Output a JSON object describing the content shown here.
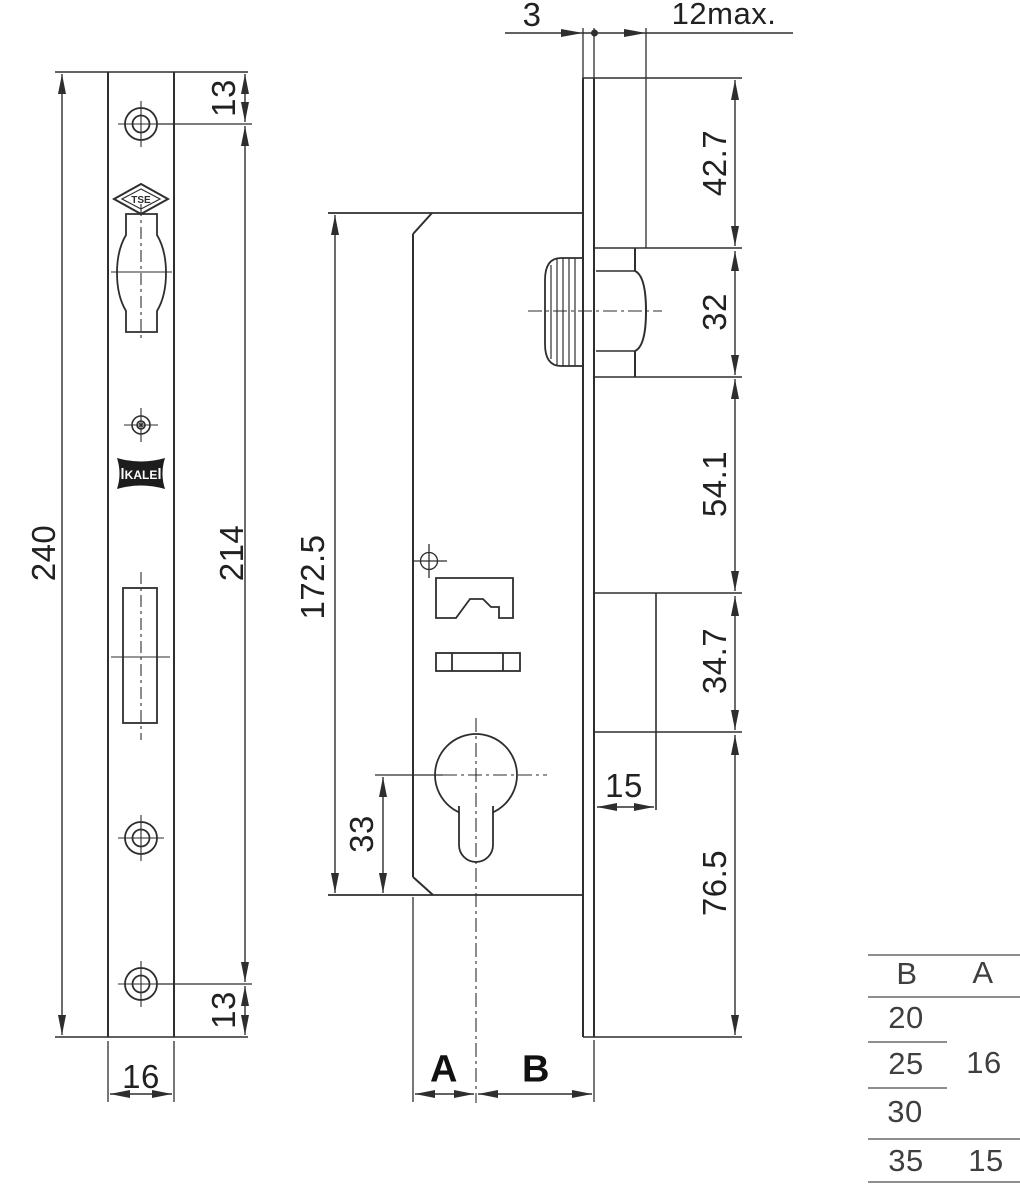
{
  "front_view": {
    "logos": {
      "tse": "TSE",
      "kale": "KALE"
    },
    "dims": {
      "total_height": "240",
      "top_hole_offset": "13",
      "hole_spacing": "214",
      "bottom_hole_offset": "13",
      "faceplate_width": "16"
    }
  },
  "side_view": {
    "dims": {
      "case_height": "172.5",
      "cylinder_to_bottom": "33",
      "dim_a": "A",
      "dim_b": "B"
    }
  },
  "edge_view": {
    "dims": {
      "faceplate_thickness": "3",
      "max_projection": "12max.",
      "seg_top": "42.7",
      "seg_roller": "32",
      "seg_mid": "54.1",
      "seg_lower": "34.7",
      "cover_width": "15",
      "seg_bottom": "76.5"
    }
  },
  "size_table": {
    "headers": {
      "b": "B",
      "a": "A"
    },
    "b_values": [
      "20",
      "25",
      "30",
      "35"
    ],
    "a_shared": "16",
    "a_last": "15"
  }
}
